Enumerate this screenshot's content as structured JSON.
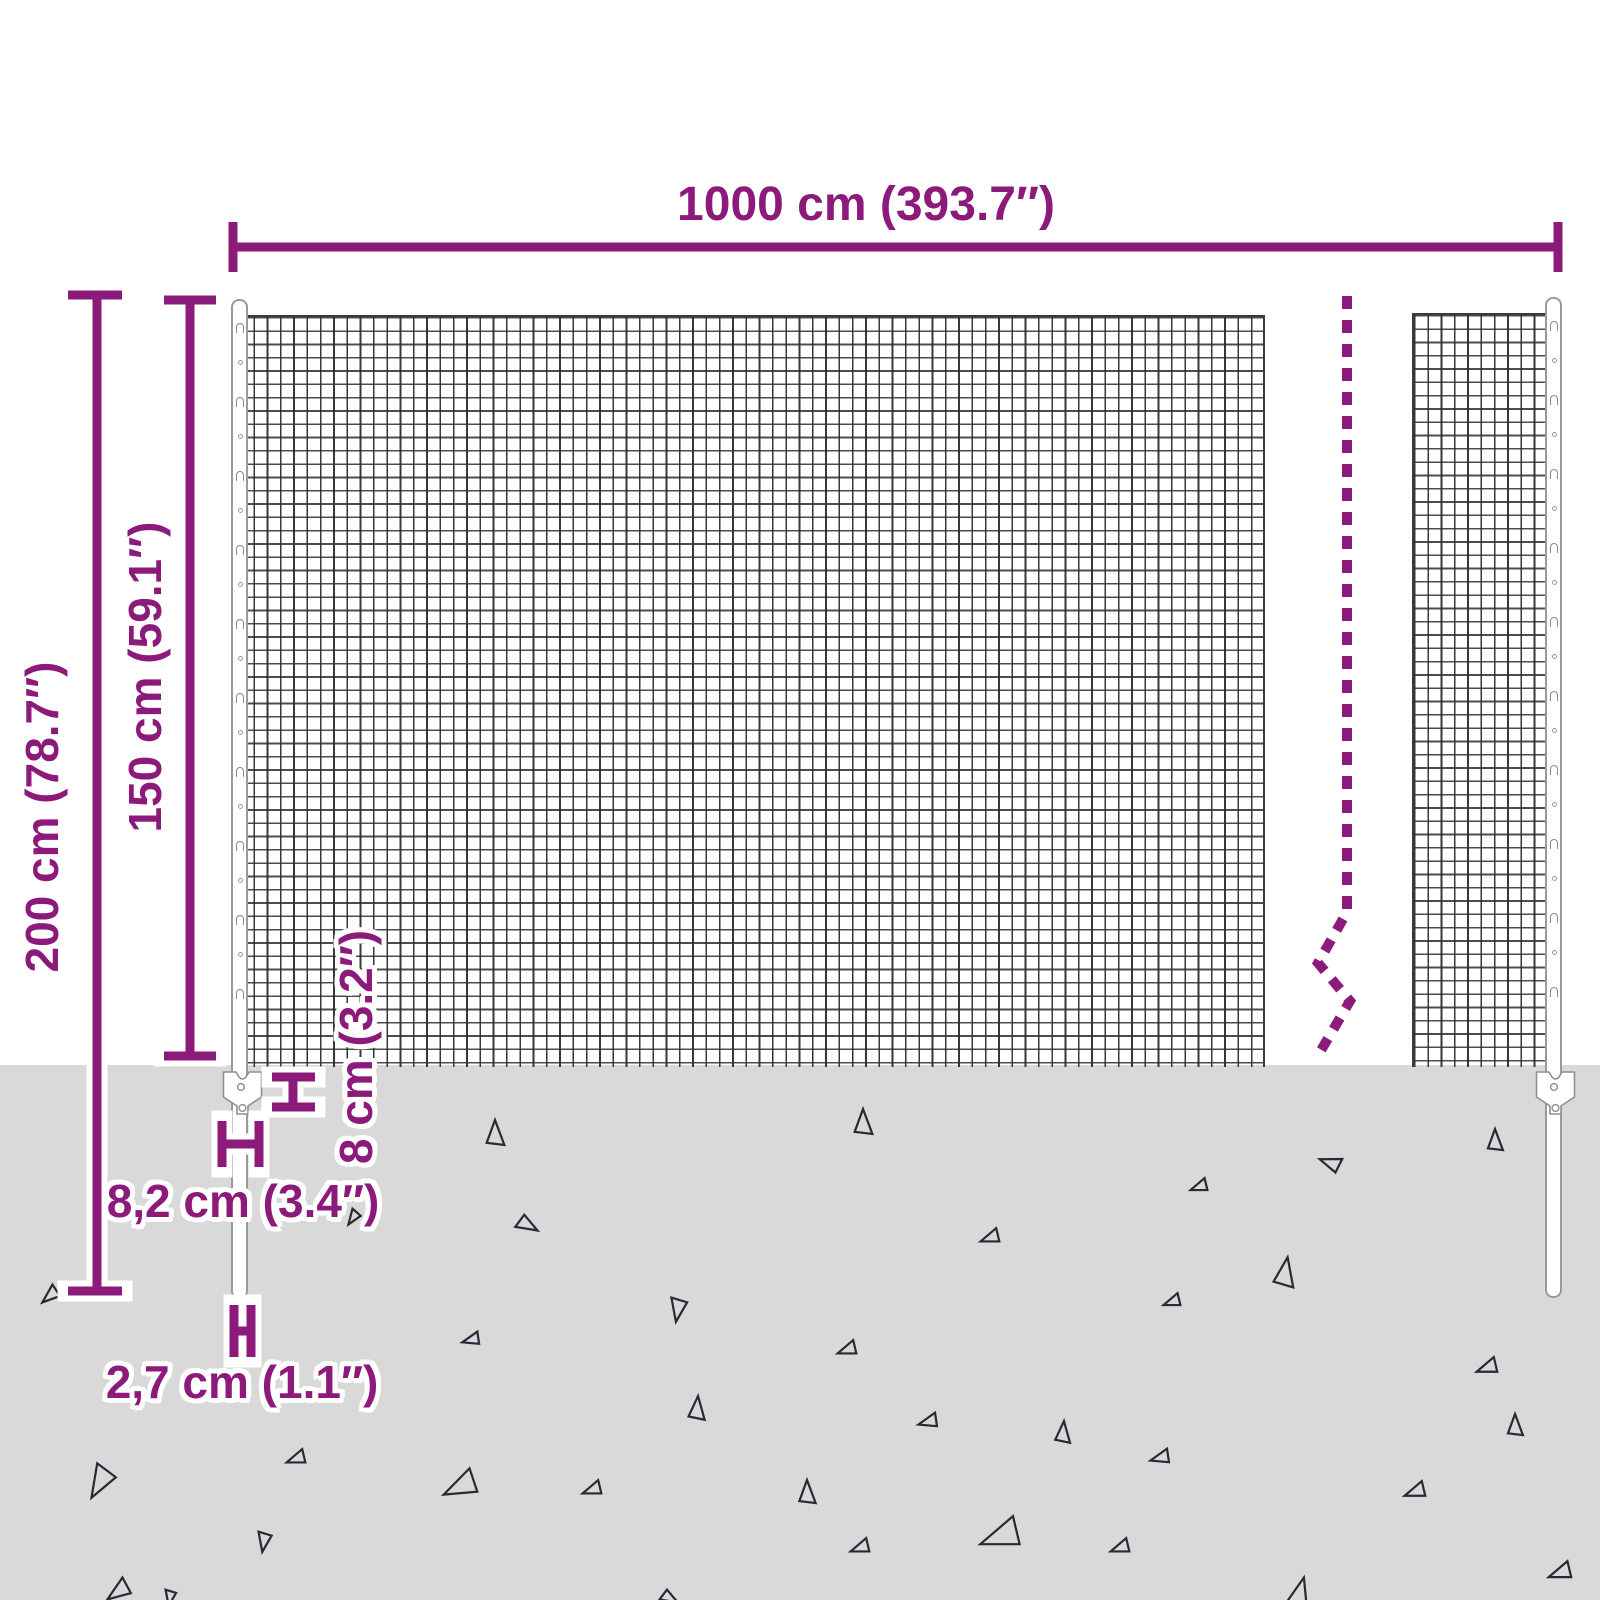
{
  "labels": {
    "width": "1000 cm (393.7″)",
    "total_height": "200 cm (78.7″)",
    "mesh_height": "150 cm (59.1″)",
    "anchor_plate_height": "8 cm (3.2″)",
    "anchor_plate_width": "8,2 cm (3.4″)",
    "spike_width": "2,7 cm (1.1″)"
  },
  "colors": {
    "dimension_purple": "#8C1A7B",
    "ground_gray": "#D9D9D9",
    "mesh_line": "#2D2D2D",
    "outline_gray": "#9A9A9A",
    "triangle_dark": "#252A35"
  },
  "posts": {
    "hook_spacing": 37,
    "hook_start": 22
  },
  "ground": {
    "triangles": [
      {
        "x": 495,
        "y": 1133,
        "s": 26,
        "r": 0
      },
      {
        "x": 863,
        "y": 1122,
        "s": 26,
        "r": 0
      },
      {
        "x": 1495,
        "y": 1140,
        "s": 22,
        "r": 0
      },
      {
        "x": 353,
        "y": 1218,
        "s": 16,
        "r": 215
      },
      {
        "x": 50,
        "y": 1296,
        "s": 20,
        "r": 230
      },
      {
        "x": 1199,
        "y": 1187,
        "s": 18,
        "r": 250
      },
      {
        "x": 1330,
        "y": 1163,
        "s": 22,
        "r": 290
      },
      {
        "x": 528,
        "y": 1225,
        "s": 22,
        "r": 120
      },
      {
        "x": 990,
        "y": 1238,
        "s": 20,
        "r": 250
      },
      {
        "x": 1285,
        "y": 1272,
        "s": 30,
        "r": 10
      },
      {
        "x": 1172,
        "y": 1302,
        "s": 18,
        "r": 250
      },
      {
        "x": 471,
        "y": 1340,
        "s": 18,
        "r": 255
      },
      {
        "x": 678,
        "y": 1310,
        "s": 24,
        "r": 190
      },
      {
        "x": 847,
        "y": 1350,
        "s": 20,
        "r": 250
      },
      {
        "x": 1487,
        "y": 1368,
        "s": 22,
        "r": 250
      },
      {
        "x": 697,
        "y": 1408,
        "s": 24,
        "r": 5
      },
      {
        "x": 928,
        "y": 1422,
        "s": 20,
        "r": 255
      },
      {
        "x": 296,
        "y": 1459,
        "s": 20,
        "r": 250
      },
      {
        "x": 100,
        "y": 1483,
        "s": 34,
        "r": 210
      },
      {
        "x": 460,
        "y": 1487,
        "s": 36,
        "r": 245
      },
      {
        "x": 592,
        "y": 1490,
        "s": 20,
        "r": 250
      },
      {
        "x": 807,
        "y": 1492,
        "s": 24,
        "r": 0
      },
      {
        "x": 1063,
        "y": 1432,
        "s": 22,
        "r": 5
      },
      {
        "x": 1160,
        "y": 1458,
        "s": 20,
        "r": 255
      },
      {
        "x": 1515,
        "y": 1425,
        "s": 22,
        "r": 0
      },
      {
        "x": 1415,
        "y": 1492,
        "s": 22,
        "r": 250
      },
      {
        "x": 264,
        "y": 1542,
        "s": 20,
        "r": 190
      },
      {
        "x": 860,
        "y": 1548,
        "s": 20,
        "r": 250
      },
      {
        "x": 1000,
        "y": 1537,
        "s": 42,
        "r": 250
      },
      {
        "x": 1120,
        "y": 1548,
        "s": 20,
        "r": 250
      },
      {
        "x": 118,
        "y": 1592,
        "s": 26,
        "r": 235
      },
      {
        "x": 170,
        "y": 1598,
        "s": 16,
        "r": 190
      },
      {
        "x": 670,
        "y": 1598,
        "s": 18,
        "r": 120
      },
      {
        "x": 1300,
        "y": 1592,
        "s": 30,
        "r": 15
      },
      {
        "x": 1560,
        "y": 1573,
        "s": 24,
        "r": 250
      }
    ]
  }
}
